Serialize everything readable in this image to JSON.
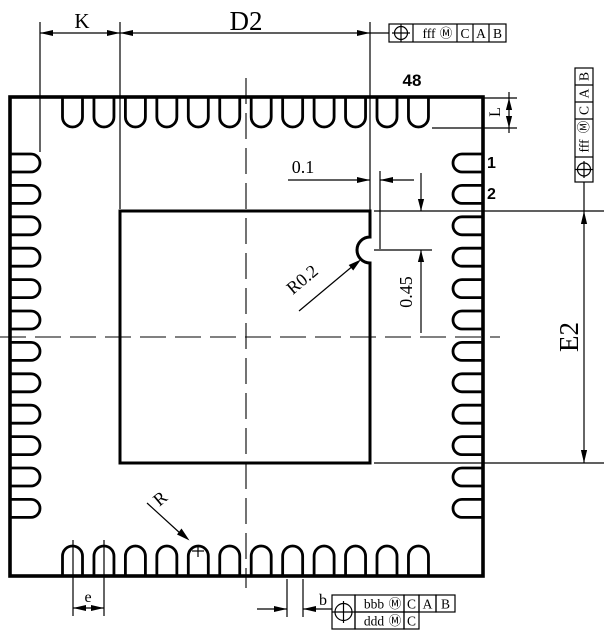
{
  "drawing": {
    "background": "#ffffff",
    "line_color": "#000000",
    "pins_per_side": 12,
    "labels": {
      "k": "K",
      "d2": "D2",
      "l": "L",
      "e2": "E2",
      "gap_0_1": "0.1",
      "notch_offset": "0.45",
      "notch_radius": "R0.2",
      "terminal_radius": "R",
      "pitch_e": "e",
      "width_b": "b",
      "pin_48": "48",
      "pin_1": "1",
      "pin_2": "2"
    },
    "fcf_top": {
      "symbol": "⊕",
      "tolerance": "fff",
      "modifier": "Ⓜ",
      "datum_1": "C",
      "datum_2": "A",
      "datum_3": "B"
    },
    "fcf_right": {
      "symbol": "⊕",
      "tolerance": "fff",
      "modifier": "Ⓜ",
      "datum_1": "C",
      "datum_2": "A",
      "datum_3": "B"
    },
    "fcf_bottom": {
      "symbol": "⊕",
      "row_1": {
        "tolerance": "bbb",
        "modifier": "Ⓜ",
        "datum_1": "C",
        "datum_2": "A",
        "datum_3": "B"
      },
      "row_2": {
        "tolerance": "ddd",
        "modifier": "Ⓜ",
        "datum_1": "C"
      }
    }
  }
}
